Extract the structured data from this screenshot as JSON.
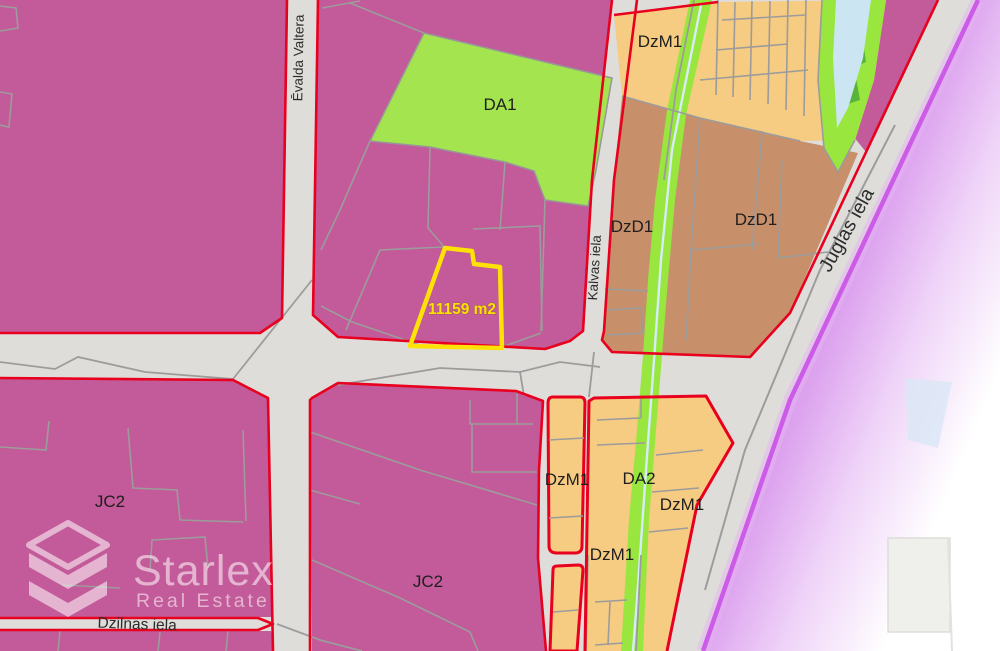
{
  "zone_labels": {
    "da1": "DA1",
    "dzm1_north": "DzM1",
    "dzd1_west": "DzD1",
    "dzd1_east": "DzD1",
    "jc2_west": "JC2",
    "jc2_central": "JC2",
    "dzm1_strip": "DzM1",
    "da2": "DA2",
    "dzm1_southeast": "DzM1",
    "dzm1_south": "DzM1"
  },
  "streets": {
    "evalda_valtera": "Ēvalda Valtera",
    "kalvas_iela": "Kalvas iela",
    "juglas_iela": "Juglas iela",
    "dzilnas_iela": "Dzilnas iela"
  },
  "highlight": {
    "area": "11159 m2"
  },
  "watermark": {
    "brand": "Starlex",
    "tagline": "Real Estate"
  },
  "colors": {
    "zone_pink": "#C35A99",
    "zone_orange": "#F6CB82",
    "zone_brown": "#C78F6A",
    "zone_green": "#A4E44F",
    "greenway_green": "#98E63E",
    "dark_green": "#58B43B",
    "water_blue": "#CBE5F3",
    "road_gray": "#DEDDDA",
    "zone_border_red": "#E8001E",
    "parcel_line_gray": "#9C9C9C",
    "highlight_yellow": "#FFE205",
    "boundary_purple": "#CC5BE8",
    "purple_glow": "#E5B4F2",
    "label_dark": "#1E1E1E",
    "watermark_white": "#FFFFFF"
  }
}
